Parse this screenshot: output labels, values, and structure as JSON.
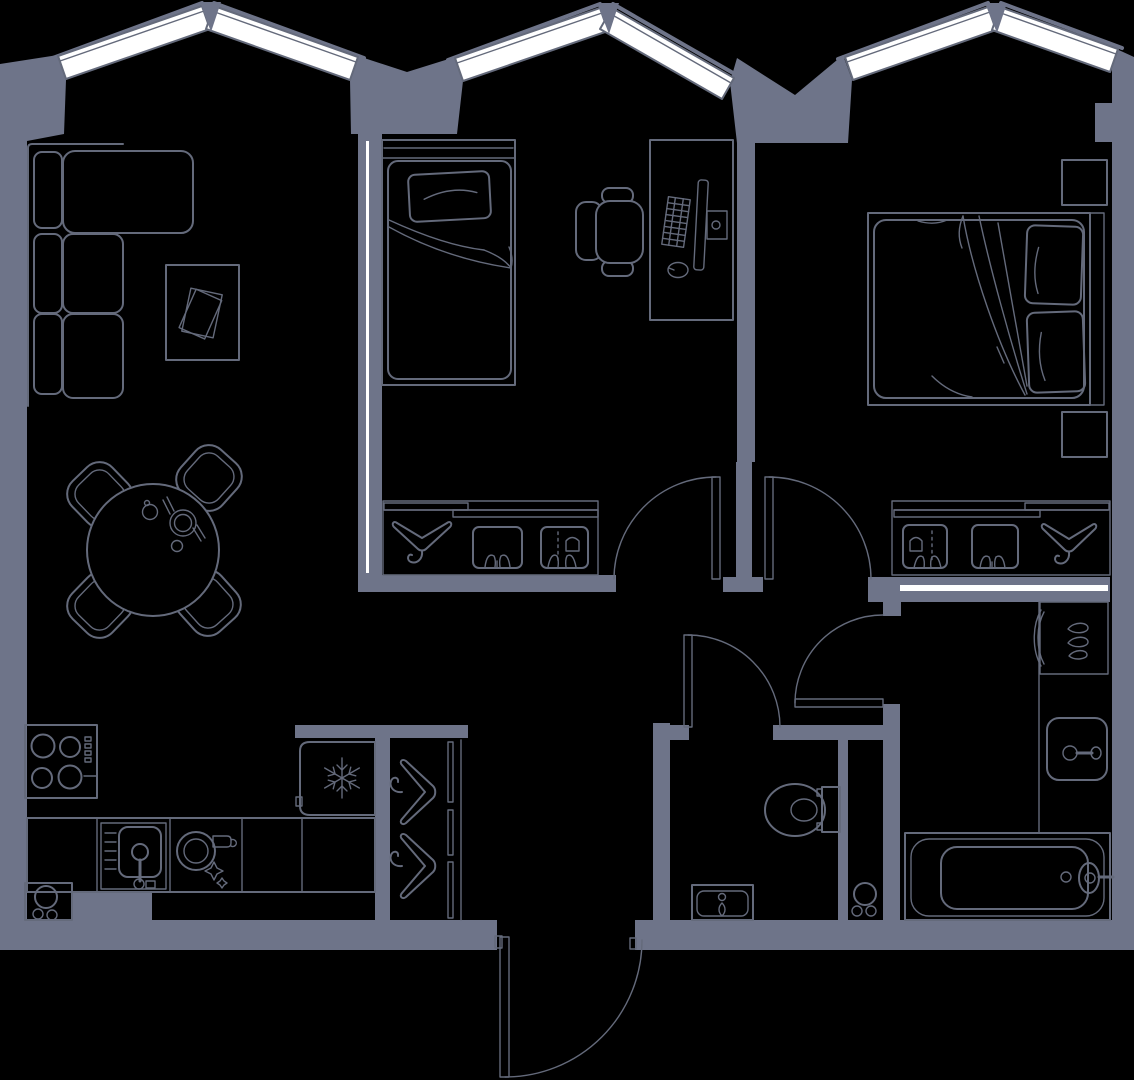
{
  "diagram": {
    "type": "floor-plan",
    "view": "top-down",
    "text_labels": []
  },
  "colors": {
    "background": "#000000",
    "wall": "#6e7489",
    "line": "#646a7b",
    "window": "#ffffff"
  },
  "windows": {
    "bay_count": 3,
    "panels_per_bay": 2,
    "shape": "peaked-bay"
  },
  "doors": [
    {
      "name": "bedroom-1-door",
      "swing": "left-into-hall"
    },
    {
      "name": "bedroom-2-door",
      "swing": "right-into-hall"
    },
    {
      "name": "wc-door",
      "swing": "right-into-hall"
    },
    {
      "name": "bathroom-door",
      "swing": "up-into-hall"
    },
    {
      "name": "entry-door",
      "swing": "inward-bottom"
    }
  ],
  "rooms": [
    {
      "name": "living-room-kitchen",
      "items": [
        "corner-sofa",
        "coffee-table-with-magazine",
        "round-dining-table",
        "dining-chairs-x4",
        "cup",
        "plate-with-cutlery",
        "cooktop-4-burners",
        "kitchen-counter",
        "kitchen-sink",
        "dish-and-glass",
        "base-cabinet",
        "refrigerator-snowflake"
      ]
    },
    {
      "name": "hall",
      "items": [
        "open-wardrobe-two-hangers",
        "entry-door"
      ]
    },
    {
      "name": "bedroom-1",
      "items": [
        "single-bed",
        "desk",
        "office-chair",
        "monitor",
        "keyboard",
        "mouse",
        "sliding-closet-hanger-two-boxes"
      ]
    },
    {
      "name": "bedroom-2",
      "items": [
        "double-bed",
        "two-pillows",
        "nightstand-x2",
        "sliding-closet-hanger-two-boxes"
      ]
    },
    {
      "name": "wc",
      "items": [
        "toilet",
        "small-sink"
      ]
    },
    {
      "name": "shaft",
      "items": [
        "pipe-risers-x3"
      ]
    },
    {
      "name": "bathroom",
      "items": [
        "bathtub",
        "washbasin",
        "towel-dryer-three-drops"
      ]
    }
  ]
}
